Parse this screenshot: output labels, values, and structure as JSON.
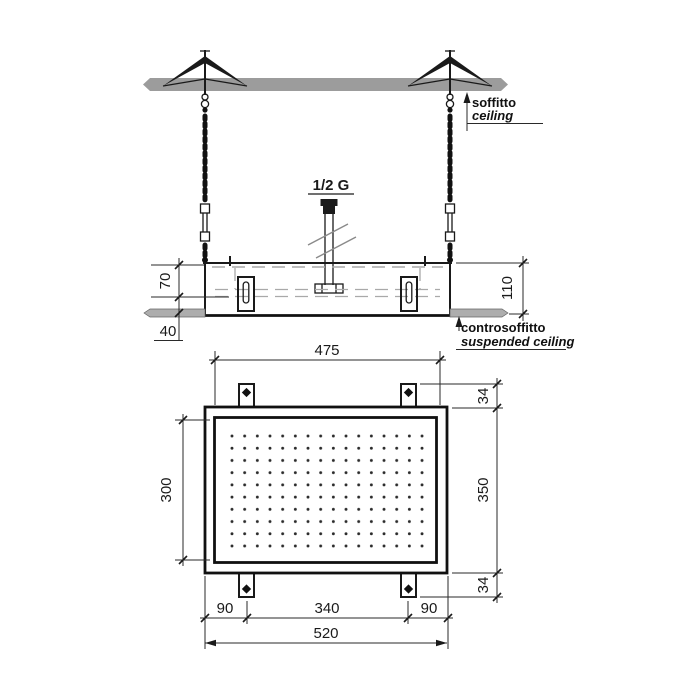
{
  "drawing": {
    "labels": {
      "connection": "1/2 G",
      "ceiling_primary": "soffitto",
      "ceiling_secondary": "ceiling",
      "suspended_primary": "controsoffitto",
      "suspended_secondary": "suspended ceiling"
    },
    "dimensions": {
      "recess_top": "70",
      "recess_total": "110",
      "flange_drop": "40",
      "spray_width": "475",
      "tab_top": "34",
      "body_height": "350",
      "tab_bottom": "34",
      "spray_height": "300",
      "margin_left": "90",
      "tab_span": "340",
      "margin_right": "90",
      "body_width": "520"
    },
    "colors": {
      "ceiling_fill": "#9c9c9c",
      "suspended_fill": "#adadad",
      "line": "#1a1a1a",
      "dim_line": "#2a2a2a",
      "hidden_line": "#a9a9a9"
    }
  }
}
